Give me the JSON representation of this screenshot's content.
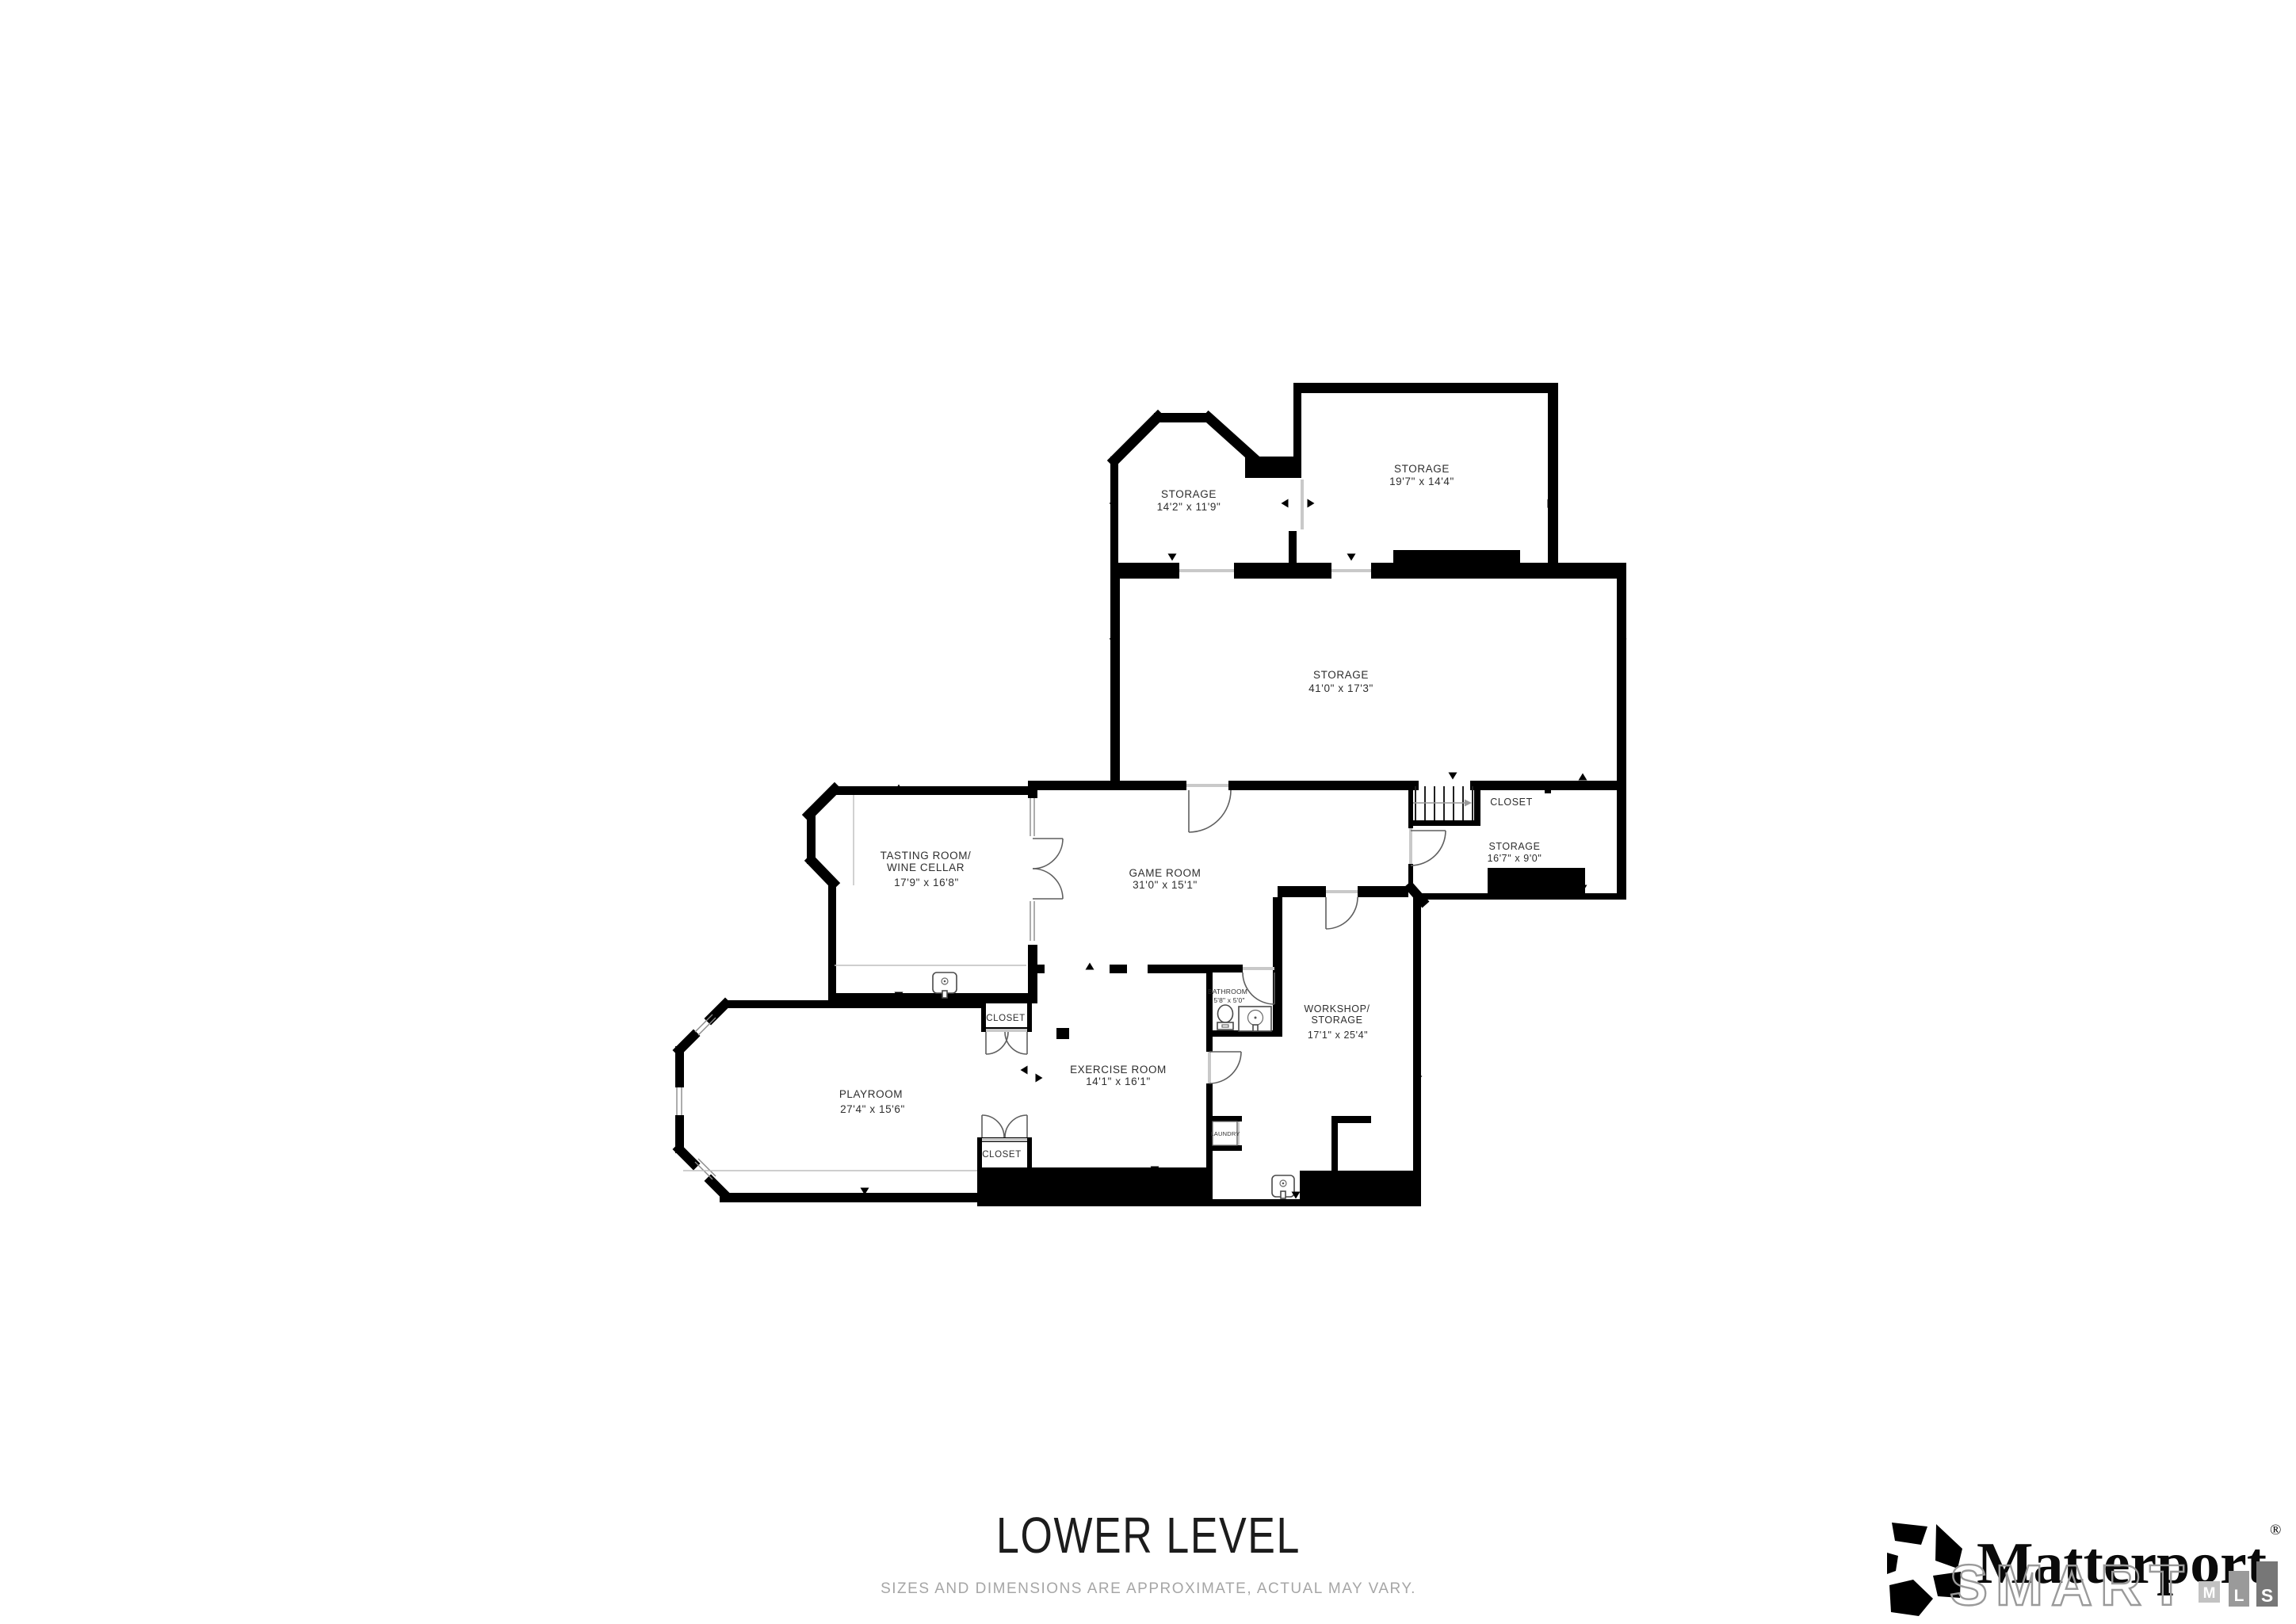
{
  "floor_plan": {
    "rooms": {
      "storage_angled": {
        "name": "STORAGE",
        "dims": "14'2\" x 11'9\""
      },
      "storage_top": {
        "name": "STORAGE",
        "dims": "19'7\" x 14'4\""
      },
      "storage_main": {
        "name": "STORAGE",
        "dims": "41'0\" x 17'3\""
      },
      "closet_stairs": {
        "name": "CLOSET"
      },
      "storage_side": {
        "name": "STORAGE",
        "dims": "16'7\" x 9'0\""
      },
      "tasting": {
        "name_line1": "TASTING ROOM/",
        "name_line2": "WINE CELLAR",
        "dims": "17'9\" x 16'8\""
      },
      "game": {
        "name": "GAME ROOM",
        "dims": "31'0\" x 15'1\""
      },
      "bathroom": {
        "name": "BATHROOM",
        "dims": "5'8\" x 5'0\""
      },
      "workshop": {
        "name_line1": "WORKSHOP/",
        "name_line2": "STORAGE",
        "dims": "17'1\" x 25'4\""
      },
      "exercise": {
        "name": "EXERCISE ROOM",
        "dims": "14'1\" x 16'1\""
      },
      "playroom": {
        "name": "PLAYROOM",
        "dims": "27'4\" x 15'6\""
      },
      "closet_upper": {
        "name": "CLOSET"
      },
      "closet_lower": {
        "name": "CLOSET"
      },
      "laundry": {
        "name": "LAUNDRY"
      }
    },
    "footer": {
      "title": "LOWER LEVEL",
      "disclaimer": "SIZES AND DIMENSIONS ARE APPROXIMATE, ACTUAL MAY VARY."
    }
  },
  "branding": {
    "wordmark": "Matterport",
    "registered": "®",
    "watermark": "SMART",
    "mls": {
      "m": "M",
      "l": "L",
      "s": "S"
    }
  },
  "colors": {
    "wall": "#000000",
    "background": "#ffffff",
    "label": "#2e2e2e",
    "muted": "#a6a6a6"
  }
}
